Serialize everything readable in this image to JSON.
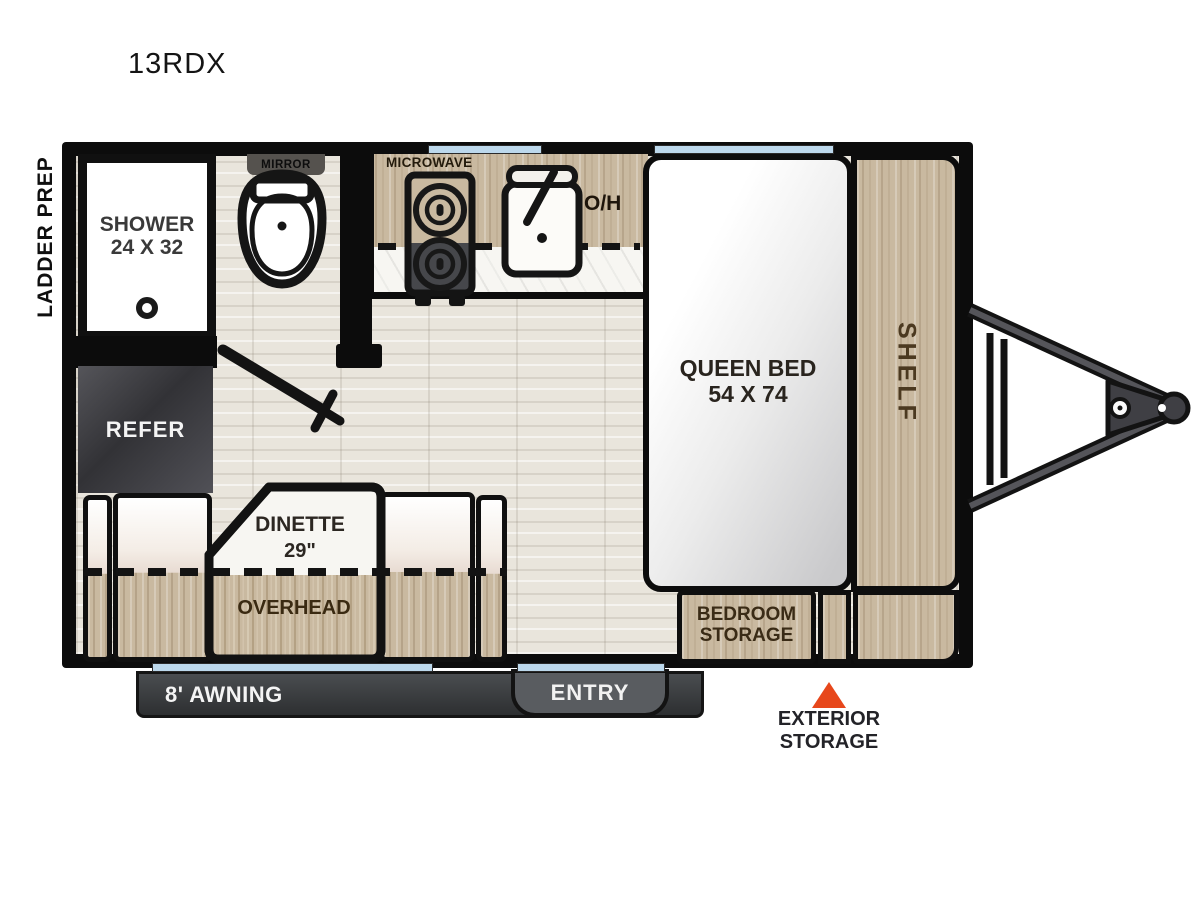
{
  "title": "13RDX",
  "labels": {
    "ladder_prep": "LADDER PREP",
    "shower_l1": "SHOWER",
    "shower_l2": "24 X 32",
    "mirror": "MIRROR",
    "microwave": "MICROWAVE",
    "oh": "O/H",
    "queen_l1": "QUEEN BED",
    "queen_l2": "54 X 74",
    "shelf": "SHELF",
    "refer": "REFER",
    "dinette_l1": "DINETTE",
    "dinette_l2": "29\"",
    "overhead": "OVERHEAD",
    "bedroom_l1": "BEDROOM",
    "bedroom_l2": "STORAGE",
    "awning": "8' AWNING",
    "entry": "ENTRY",
    "ext_l1": "EXTERIOR",
    "ext_l2": "STORAGE"
  },
  "icons": {
    "toilet": "toilet-top-view",
    "sink": "sink-with-faucet",
    "cooktop": "two-burner-stove",
    "shower_drain": "circle-ring",
    "door_swing": "diagonal-door-with-cross-handle",
    "hitch": "a-frame-trailer-tongue",
    "exterior_storage_marker": "orange-triangle-up",
    "window": "light-blue-wall-strip"
  },
  "colors": {
    "wall_black": "#0C0C0C",
    "window_blue": "#BCD8EC",
    "cabinet_wood": "#C9B9A0",
    "floor_wood": "#E9E5DC",
    "counter_marble": "#F7F6F2",
    "awning_gray": "#3A3C3F",
    "entry_gray": "#595C60",
    "refer_gray": "#404044",
    "marker_orange": "#E7471B"
  }
}
